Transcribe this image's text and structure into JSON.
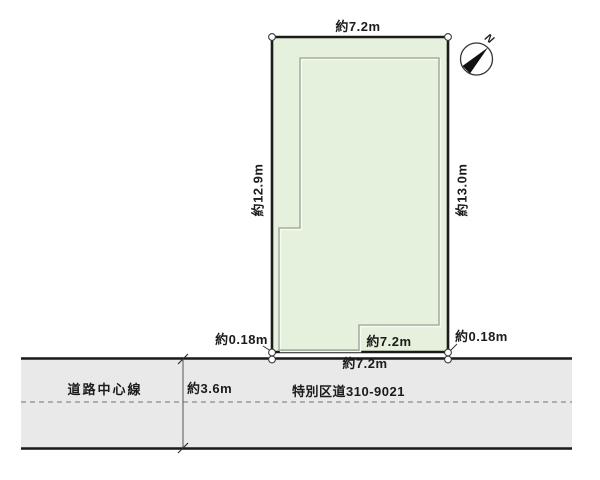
{
  "diagram": {
    "plot": {
      "top_width_label": "約7.2m",
      "left_depth_label": "約12.9m",
      "right_depth_label": "約13.0m",
      "inner_bottom_width_label": "約7.2m",
      "bottom_width_label": "約7.2m",
      "left_setback_label": "約0.18m",
      "right_setback_label": "約0.18m",
      "fill_color": "#e5f0dd",
      "outline_color": "#1b1b1b"
    },
    "road": {
      "centerline_label": "道路中心線",
      "width_label": "約3.6m",
      "name_label": "特別区道310-9021",
      "fill_color": "#e9e9e9"
    },
    "compass": {
      "north_label": "N"
    }
  }
}
